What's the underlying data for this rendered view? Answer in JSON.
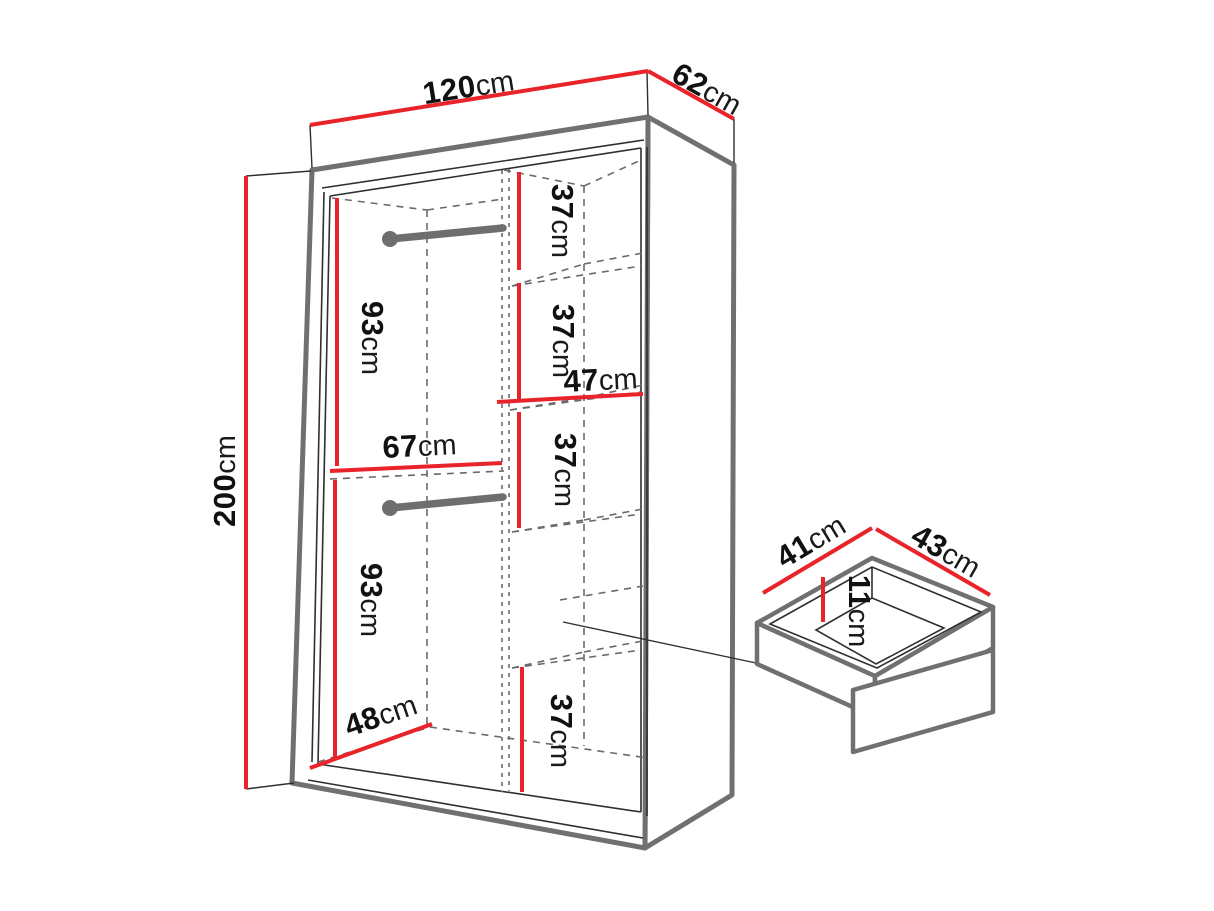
{
  "diagram": {
    "type": "furniture-dimension-diagram",
    "subject": "wardrobe interior dimensions with pull-out drawer detail",
    "colors": {
      "dimension_line": "#e8232a",
      "body_outline": "#707070",
      "detail_line": "#2f2f2f",
      "label_text": "#111111",
      "background": "#ffffff"
    },
    "wardrobe": {
      "width": {
        "value": "120",
        "unit": "cm"
      },
      "depth": {
        "value": "62",
        "unit": "cm"
      },
      "height": {
        "value": "200",
        "unit": "cm"
      },
      "upper_hanging_height": {
        "value": "93",
        "unit": "cm"
      },
      "lower_hanging_height": {
        "value": "93",
        "unit": "cm"
      },
      "hanging_section_width": {
        "value": "67",
        "unit": "cm"
      },
      "shelf_width": {
        "value": "47",
        "unit": "cm"
      },
      "interior_depth": {
        "value": "48",
        "unit": "cm"
      },
      "shelf_heights": [
        {
          "value": "37",
          "unit": "cm"
        },
        {
          "value": "37",
          "unit": "cm"
        },
        {
          "value": "37",
          "unit": "cm"
        },
        {
          "value": "37",
          "unit": "cm"
        }
      ]
    },
    "drawer": {
      "width": {
        "value": "41",
        "unit": "cm"
      },
      "depth": {
        "value": "43",
        "unit": "cm"
      },
      "height": {
        "value": "11",
        "unit": "cm"
      }
    }
  }
}
